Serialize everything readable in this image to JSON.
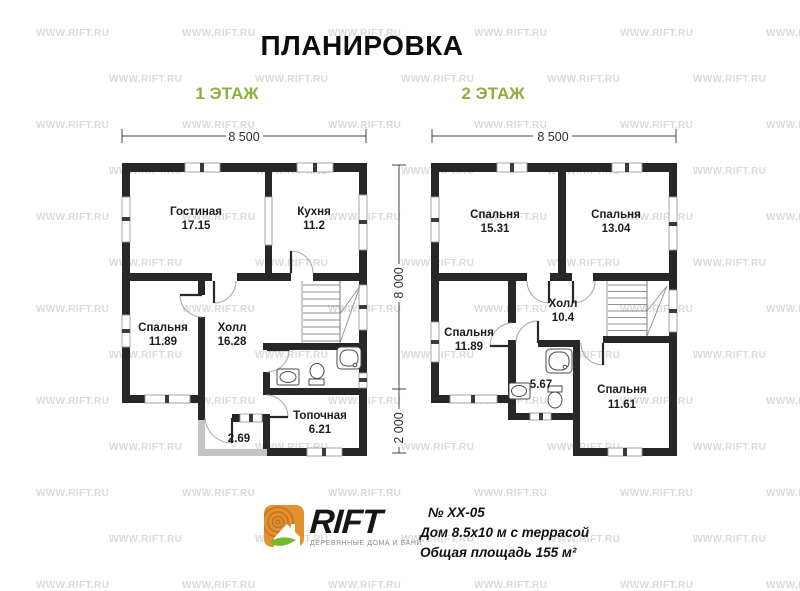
{
  "title": "ПЛАНИРОВКА",
  "floors": [
    {
      "label": "1 ЭТАЖ",
      "rooms": {
        "living": {
          "name": "Гостиная",
          "area": "17.15"
        },
        "kitchen": {
          "name": "Кухня",
          "area": "11.2"
        },
        "bedroom": {
          "name": "Спальня",
          "area": "11.89"
        },
        "hall": {
          "name": "Холл",
          "area": "16.28"
        },
        "boiler": {
          "name": "Топочная",
          "area": "6.21"
        },
        "entry": {
          "area": "2.69"
        }
      }
    },
    {
      "label": "2 ЭТАЖ",
      "rooms": {
        "bedroom1": {
          "name": "Спальня",
          "area": "15.31"
        },
        "bedroom2": {
          "name": "Спальня",
          "area": "13.04"
        },
        "bedroom3": {
          "name": "Спальня",
          "area": "11.89"
        },
        "hall": {
          "name": "Холл",
          "area": "10.4"
        },
        "bathroom": {
          "area": "5.67"
        },
        "bedroom4": {
          "name": "Спальня",
          "area": "11.61"
        }
      }
    }
  ],
  "dimensions": {
    "width": "8 500",
    "height_main": "8 000",
    "height_ext": "2 000"
  },
  "footer": {
    "brand": "RIFT",
    "tagline": "ДЕРЕВЯННЫЕ ДОМА И БАНИ",
    "project_no": "№ XX-05",
    "description": "Дом 8.5x10 м с террасой",
    "total_area": "Общая площадь 155 м²"
  },
  "watermark": {
    "text": "WWW.RIFT.RU"
  },
  "colors": {
    "wall": "#272727",
    "porch_wall": "#c4c4c4",
    "accent_green": "#8fae3b",
    "logo_orange": "#e5902f",
    "leaf_green": "#76b82a",
    "watermark": "#dbdbd3"
  }
}
